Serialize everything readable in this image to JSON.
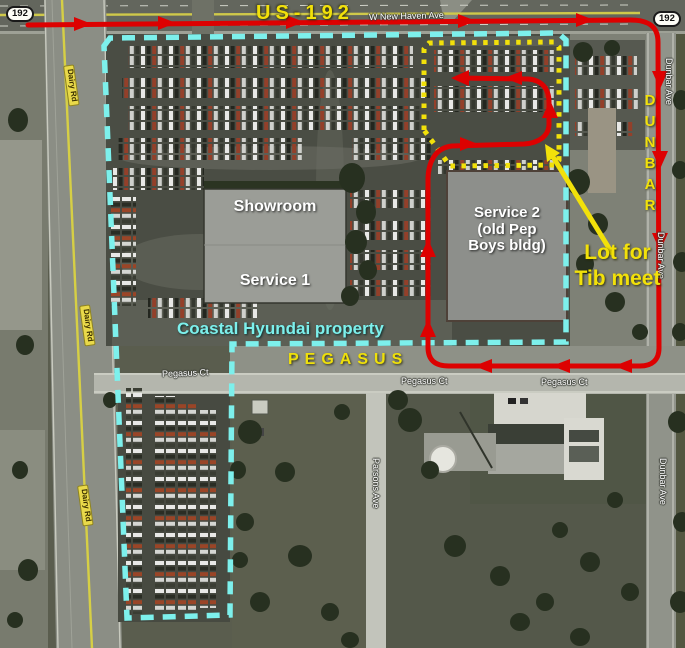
{
  "shields": {
    "left": "192",
    "right": "192"
  },
  "roads": {
    "us192": "US-192",
    "w_new_haven": "W New Haven Ave",
    "dunbar_big": "DUNBAR",
    "dunbar_ave": "Dunbar Ave",
    "pegasus_big": "PEGASUS",
    "pegasus_ct": "Pegasus Ct",
    "dairy_rd": "Dairy Rd",
    "parsons_ave": "Parsons Ave"
  },
  "buildings": {
    "showroom": "Showroom",
    "service1": "Service 1",
    "service2_lines": [
      "Service 2",
      "(old Pep",
      "Boys bldg)"
    ]
  },
  "annotations": {
    "property": "Coastal Hyundai property",
    "lot_note_lines": [
      "Lot for",
      "Tib meet"
    ]
  },
  "colors": {
    "route_red": "#dd0101",
    "annotation_yellow": "#f2e10a",
    "property_cyan": "#7df0ec",
    "street_label_white": "#ffffff",
    "dairy_label_bg": "#e9d94a"
  }
}
